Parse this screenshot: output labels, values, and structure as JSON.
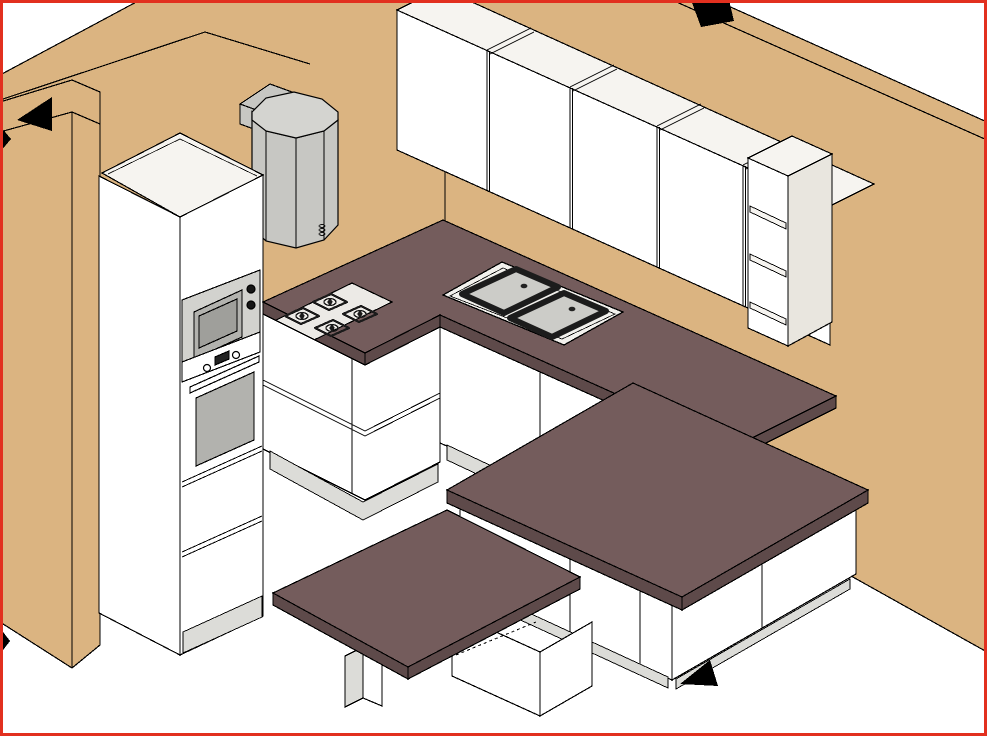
{
  "scene": {
    "type": "kitchen-planner-3d-view",
    "style": "isometric-line-render",
    "has_text": false
  },
  "colors": {
    "background": "#ffffff",
    "border": "#e2301f",
    "wall": "#dbb481",
    "counter": "#745c5c",
    "counter_edge": "#5e4a4a",
    "cabinet": "#ffffff",
    "cabinet_top": "#f6f4f0",
    "cabinet_side": "#e9e6df",
    "plinth": "#dcdcd8",
    "hood_body": "#c7c7c3",
    "hood_cap": "#d4d4d0",
    "appliance_gray": "#d2d2ce",
    "appliance_dark": "#b2b2ae",
    "appliance_darker": "#9f9f9b",
    "sink_bowl": "#ccccc8",
    "sink_rim": "#f2f1ed",
    "hob_tray": "#eceae6",
    "hob_edge": "#d8d6d2",
    "grate_dark": "#1b1b1b",
    "knob_dark": "#161616",
    "arrow": "#000000",
    "outline": "#000000",
    "display_dark": "#222222"
  },
  "inventory": {
    "walls": [
      "left-wall-with-end",
      "back-right-wall"
    ],
    "tall_unit": [
      "built-in-microwave",
      "built-in-oven",
      "drawer-fronts"
    ],
    "hood": "corner-extractor-hood",
    "upper_run": {
      "door_count": 4,
      "end_unit": "open-shelf-unit",
      "shelf_count": 3
    },
    "worktop": "l-shaped-counter",
    "hob": {
      "type": "gas",
      "burners": 4
    },
    "sink": {
      "type": "double-bowl",
      "drains": 2
    },
    "island": {
      "worktop": true,
      "front_doors": 2,
      "end_doors": 2
    },
    "table": "attached-dining-extension",
    "low_cabinet": "open-base-cabinet",
    "arrow_count": 5
  },
  "arrows": [
    {
      "id": "arrow-top-left",
      "location": "top-of-left-wall",
      "direction": "left"
    },
    {
      "id": "arrow-left-edge",
      "location": "left-edge-clipped",
      "direction": "right"
    },
    {
      "id": "arrow-top-right",
      "location": "top-of-right-wall-clipped",
      "direction": "up"
    },
    {
      "id": "arrow-floor-island",
      "location": "floor-beside-island",
      "direction": "left"
    },
    {
      "id": "arrow-left-edge-lower",
      "location": "left-edge-lower-clipped",
      "direction": "right"
    }
  ]
}
